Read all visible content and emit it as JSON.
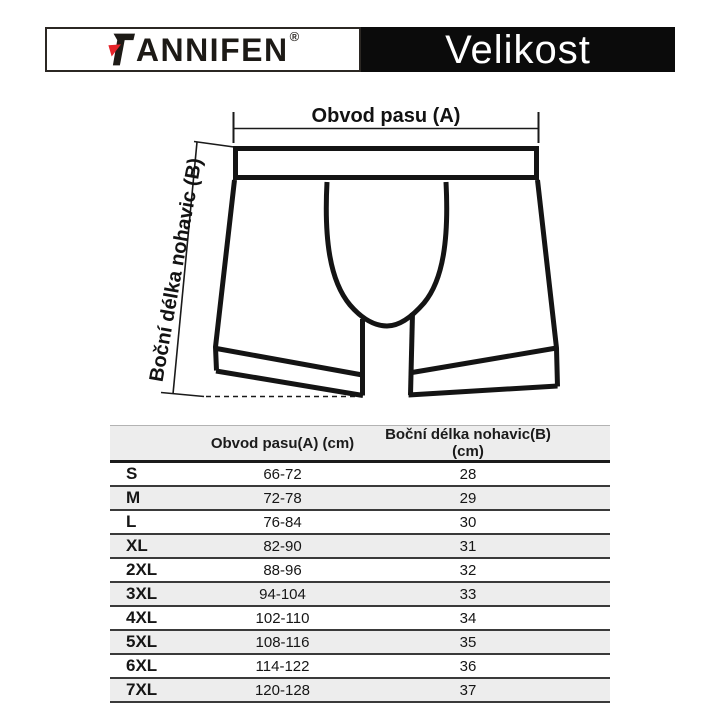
{
  "header": {
    "brand_full": "FANNIFEN",
    "brand_initial": "F",
    "brand_rest": "ANNIFEN",
    "registered_mark": "®",
    "title": "Velikost",
    "accent_red": "#e6232a",
    "banner_bg": "#0b0b0b"
  },
  "diagram": {
    "waist_label": "Obvod pasu (A)",
    "length_label": "Boční délka nohavic (B)"
  },
  "table": {
    "stripe_color": "#ededed",
    "columns": [
      "",
      "Obvod pasu(A) (cm)",
      "Boční délka nohavic(B) (cm)"
    ],
    "rows": [
      {
        "size": "S",
        "waist": "66-72",
        "length": "28"
      },
      {
        "size": "M",
        "waist": "72-78",
        "length": "29"
      },
      {
        "size": "L",
        "waist": "76-84",
        "length": "30"
      },
      {
        "size": "XL",
        "waist": "82-90",
        "length": "31"
      },
      {
        "size": "2XL",
        "waist": "88-96",
        "length": "32"
      },
      {
        "size": "3XL",
        "waist": "94-104",
        "length": "33"
      },
      {
        "size": "4XL",
        "waist": "102-110",
        "length": "34"
      },
      {
        "size": "5XL",
        "waist": "108-116",
        "length": "35"
      },
      {
        "size": "6XL",
        "waist": "114-122",
        "length": "36"
      },
      {
        "size": "7XL",
        "waist": "120-128",
        "length": "37"
      }
    ]
  }
}
